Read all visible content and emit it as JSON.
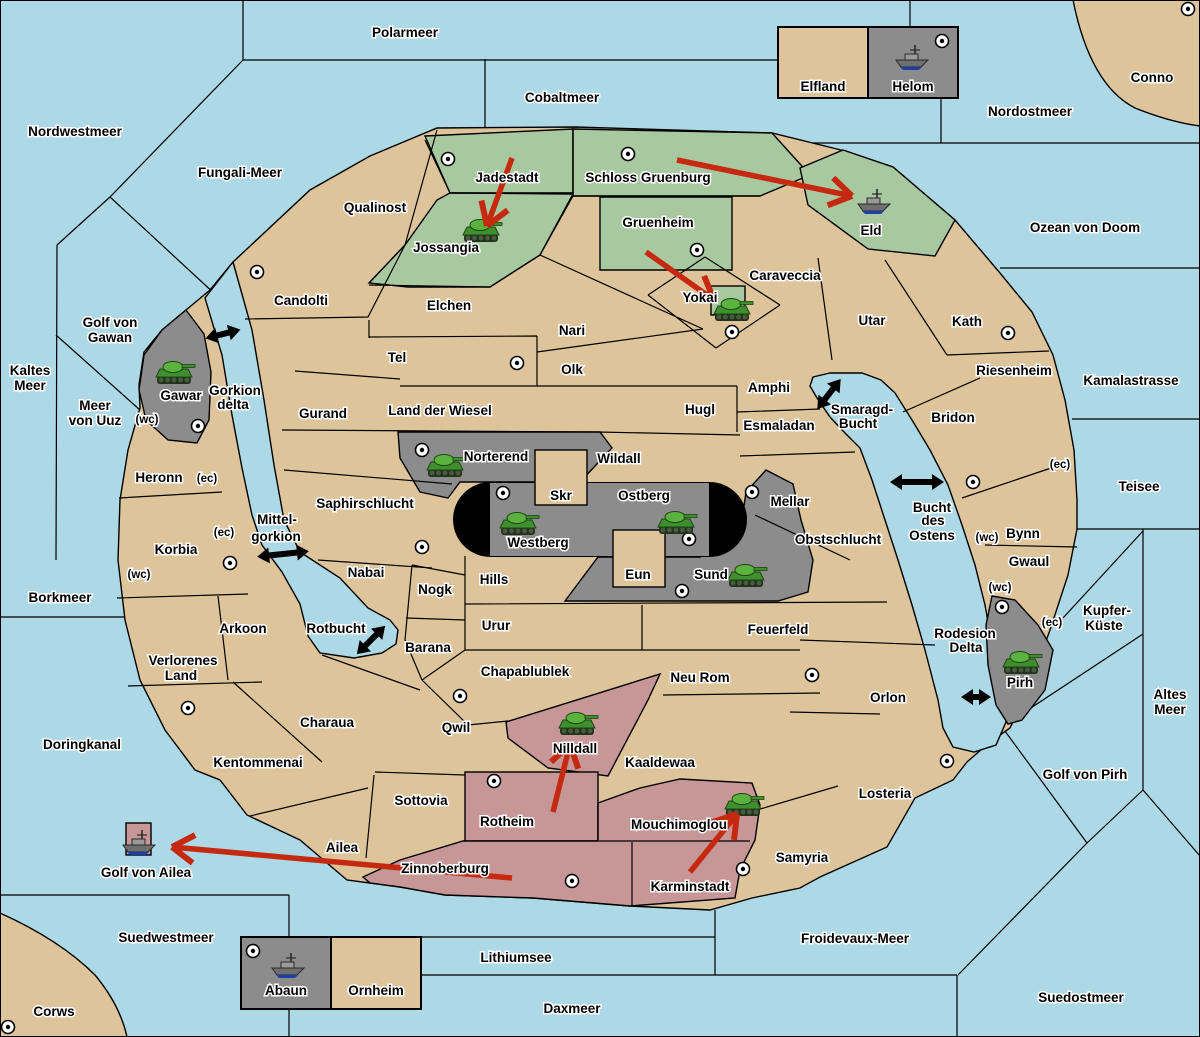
{
  "title": "Strategy map",
  "colors": {
    "sea": "#ADD8E6",
    "land": "#DEC49B",
    "green_power": "#A8C8A0",
    "gray_power": "#8C8C8C",
    "red_power": "#C79696",
    "stadium": "#000000",
    "move_arrow": "#C52A10",
    "strait_arrow": "#000000"
  },
  "map": {
    "sea_labels": [
      {
        "t": "Polarmeer",
        "x": 405,
        "y": 37
      },
      {
        "t": "Nordwestmeer",
        "x": 75,
        "y": 136
      },
      {
        "t": "Fungali-Meer",
        "x": 240,
        "y": 177
      },
      {
        "t": "Cobaltmeer",
        "x": 562,
        "y": 102
      },
      {
        "t": "Nordostmeer",
        "x": 1030,
        "y": 116
      },
      {
        "t": "Ozean von Doom",
        "x": 1085,
        "y": 232
      },
      {
        "t": "Kaltes",
        "x": 30,
        "y": 375
      },
      {
        "t": "Meer",
        "x": 30,
        "y": 390
      },
      {
        "t": "Golf von",
        "x": 110,
        "y": 327
      },
      {
        "t": "Gawan",
        "x": 110,
        "y": 342
      },
      {
        "t": "Meer",
        "x": 95,
        "y": 410
      },
      {
        "t": "von Uuz",
        "x": 95,
        "y": 425
      },
      {
        "t": "Kamalastrasse",
        "x": 1131,
        "y": 385
      },
      {
        "t": "Teisee",
        "x": 1139,
        "y": 491
      },
      {
        "t": "Borkmeer",
        "x": 60,
        "y": 602
      },
      {
        "t": "Kupfer-",
        "x": 1107,
        "y": 615
      },
      {
        "t": "Küste",
        "x": 1104,
        "y": 630
      },
      {
        "t": "Altes",
        "x": 1170,
        "y": 699
      },
      {
        "t": "Meer",
        "x": 1170,
        "y": 714
      },
      {
        "t": "Doringkanal",
        "x": 82,
        "y": 749
      },
      {
        "t": "Golf von Ailea",
        "x": 146,
        "y": 877
      },
      {
        "t": "Suedwestmeer",
        "x": 166,
        "y": 942
      },
      {
        "t": "Corws",
        "x": 54,
        "y": 1016
      },
      {
        "t": "Lithiumsee",
        "x": 516,
        "y": 962
      },
      {
        "t": "Daxmeer",
        "x": 572,
        "y": 1013
      },
      {
        "t": "Froidevaux-Meer",
        "x": 855,
        "y": 943
      },
      {
        "t": "Suedostmeer",
        "x": 1081,
        "y": 1002
      },
      {
        "t": "Golf von Pirh",
        "x": 1085,
        "y": 779
      },
      {
        "t": "Smaragd-",
        "x": 862,
        "y": 414
      },
      {
        "t": "Bucht",
        "x": 858,
        "y": 428
      },
      {
        "t": "Bucht",
        "x": 932,
        "y": 512
      },
      {
        "t": "des",
        "x": 933,
        "y": 525
      },
      {
        "t": "Ostens",
        "x": 932,
        "y": 540
      },
      {
        "t": "Rodesion",
        "x": 965,
        "y": 638
      },
      {
        "t": "Delta",
        "x": 966,
        "y": 652
      },
      {
        "t": "Mittel-",
        "x": 277,
        "y": 524
      },
      {
        "t": "gorkion",
        "x": 276,
        "y": 541
      },
      {
        "t": "Gorkion",
        "x": 235,
        "y": 395
      },
      {
        "t": "delta",
        "x": 233,
        "y": 409
      },
      {
        "t": "Rotbucht",
        "x": 336,
        "y": 633
      },
      {
        "t": "Conno",
        "x": 1152,
        "y": 82
      }
    ],
    "land_labels": [
      {
        "t": "Qualinost",
        "x": 375,
        "y": 212
      },
      {
        "t": "Jadestadt",
        "x": 507,
        "y": 182
      },
      {
        "t": "Schloss Gruenburg",
        "x": 648,
        "y": 182
      },
      {
        "t": "Gruenheim",
        "x": 658,
        "y": 227
      },
      {
        "t": "Jossangia",
        "x": 446,
        "y": 252
      },
      {
        "t": "Eld",
        "x": 871,
        "y": 235
      },
      {
        "t": "Caraveccia",
        "x": 785,
        "y": 280
      },
      {
        "t": "Candolti",
        "x": 301,
        "y": 305
      },
      {
        "t": "Elchen",
        "x": 449,
        "y": 310
      },
      {
        "t": "Nari",
        "x": 572,
        "y": 335
      },
      {
        "t": "Tel",
        "x": 397,
        "y": 362
      },
      {
        "t": "Olk",
        "x": 572,
        "y": 374
      },
      {
        "t": "Yokai",
        "x": 700,
        "y": 302
      },
      {
        "t": "Utar",
        "x": 872,
        "y": 325
      },
      {
        "t": "Kath",
        "x": 967,
        "y": 326
      },
      {
        "t": "Riesenheim",
        "x": 1014,
        "y": 375
      },
      {
        "t": "Gurand",
        "x": 323,
        "y": 418
      },
      {
        "t": "Land der Wiesel",
        "x": 440,
        "y": 415
      },
      {
        "t": "Hugl",
        "x": 700,
        "y": 414
      },
      {
        "t": "Amphi",
        "x": 769,
        "y": 392
      },
      {
        "t": "Esmaladan",
        "x": 779,
        "y": 430
      },
      {
        "t": "Bridon",
        "x": 953,
        "y": 422
      },
      {
        "t": "Gawar",
        "x": 181,
        "y": 400
      },
      {
        "t": "Norterend",
        "x": 496,
        "y": 461
      },
      {
        "t": "Wildall",
        "x": 619,
        "y": 463
      },
      {
        "t": "Skr",
        "x": 561,
        "y": 500
      },
      {
        "t": "Ostberg",
        "x": 644,
        "y": 500
      },
      {
        "t": "Westberg",
        "x": 538,
        "y": 547
      },
      {
        "t": "Mellar",
        "x": 790,
        "y": 506
      },
      {
        "t": "Obstschlucht",
        "x": 838,
        "y": 544
      },
      {
        "t": "Saphirschlucht",
        "x": 365,
        "y": 508
      },
      {
        "t": "Heronn",
        "x": 159,
        "y": 482
      },
      {
        "t": "Korbia",
        "x": 176,
        "y": 554
      },
      {
        "t": "Nabai",
        "x": 366,
        "y": 577
      },
      {
        "t": "Eun",
        "x": 638,
        "y": 579
      },
      {
        "t": "Sund",
        "x": 711,
        "y": 579
      },
      {
        "t": "Hills",
        "x": 494,
        "y": 584
      },
      {
        "t": "Nogk",
        "x": 435,
        "y": 594
      },
      {
        "t": "Bynn",
        "x": 1023,
        "y": 538
      },
      {
        "t": "Gwaul",
        "x": 1029,
        "y": 566
      },
      {
        "t": "Arkoon",
        "x": 243,
        "y": 633
      },
      {
        "t": "Urur",
        "x": 496,
        "y": 630
      },
      {
        "t": "Feuerfeld",
        "x": 778,
        "y": 634
      },
      {
        "t": "Barana",
        "x": 428,
        "y": 652
      },
      {
        "t": "Verlorenes",
        "x": 183,
        "y": 665
      },
      {
        "t": "Land",
        "x": 181,
        "y": 680
      },
      {
        "t": "Chapablublek",
        "x": 525,
        "y": 676
      },
      {
        "t": "Neu Rom",
        "x": 700,
        "y": 682
      },
      {
        "t": "Pirh",
        "x": 1020,
        "y": 687
      },
      {
        "t": "Orlon",
        "x": 888,
        "y": 702
      },
      {
        "t": "Charaua",
        "x": 327,
        "y": 727
      },
      {
        "t": "Qwil",
        "x": 456,
        "y": 732
      },
      {
        "t": "Nilldall",
        "x": 575,
        "y": 753
      },
      {
        "t": "Kaaldewaa",
        "x": 660,
        "y": 767
      },
      {
        "t": "Kentommenai",
        "x": 258,
        "y": 767
      },
      {
        "t": "Sottovia",
        "x": 421,
        "y": 805
      },
      {
        "t": "Rotheim",
        "x": 507,
        "y": 826
      },
      {
        "t": "Mouchimoglou",
        "x": 679,
        "y": 829
      },
      {
        "t": "Losteria",
        "x": 885,
        "y": 798
      },
      {
        "t": "Samyria",
        "x": 802,
        "y": 862
      },
      {
        "t": "Ailea",
        "x": 342,
        "y": 852
      },
      {
        "t": "Zinnoberburg",
        "x": 445,
        "y": 873
      },
      {
        "t": "Karminstadt",
        "x": 690,
        "y": 891
      },
      {
        "t": "Elfland",
        "x": 823,
        "y": 91
      },
      {
        "t": "Helom",
        "x": 913,
        "y": 91
      },
      {
        "t": "Abaun",
        "x": 286,
        "y": 995
      },
      {
        "t": "Ornheim",
        "x": 376,
        "y": 995
      }
    ],
    "coast_markers": [
      {
        "t": "(wc)",
        "x": 147,
        "y": 423
      },
      {
        "t": "(ec)",
        "x": 207,
        "y": 482
      },
      {
        "t": "(ec)",
        "x": 224,
        "y": 536
      },
      {
        "t": "(wc)",
        "x": 139,
        "y": 578
      },
      {
        "t": "(ec)",
        "x": 1060,
        "y": 468
      },
      {
        "t": "(wc)",
        "x": 987,
        "y": 541
      },
      {
        "t": "(wc)",
        "x": 1000,
        "y": 591
      },
      {
        "t": "(ec)",
        "x": 1052,
        "y": 626
      }
    ],
    "supply_centers": [
      [
        448,
        159
      ],
      [
        628,
        154
      ],
      [
        1188,
        9
      ],
      [
        942,
        41
      ],
      [
        257,
        272
      ],
      [
        697,
        250
      ],
      [
        732,
        332
      ],
      [
        517,
        363
      ],
      [
        198,
        426
      ],
      [
        422,
        450
      ],
      [
        503,
        493
      ],
      [
        689,
        539
      ],
      [
        682,
        591
      ],
      [
        752,
        492
      ],
      [
        1008,
        333
      ],
      [
        973,
        482
      ],
      [
        230,
        563
      ],
      [
        422,
        547
      ],
      [
        188,
        708
      ],
      [
        460,
        696
      ],
      [
        812,
        675
      ],
      [
        947,
        761
      ],
      [
        1002,
        607
      ],
      [
        494,
        781
      ],
      [
        572,
        881
      ],
      [
        743,
        869
      ],
      [
        8,
        1027
      ],
      [
        253,
        951
      ]
    ],
    "units": [
      {
        "type": "army",
        "territory": "Jossangia",
        "x": 481,
        "y": 231
      },
      {
        "type": "army",
        "territory": "Gawar",
        "x": 174,
        "y": 373
      },
      {
        "type": "army",
        "territory": "Yokai",
        "x": 732,
        "y": 310
      },
      {
        "type": "army",
        "territory": "Norterend",
        "x": 445,
        "y": 466
      },
      {
        "type": "army",
        "territory": "Westberg",
        "x": 518,
        "y": 524
      },
      {
        "type": "army",
        "territory": "Ostberg",
        "x": 676,
        "y": 523
      },
      {
        "type": "army",
        "territory": "Sund",
        "x": 746,
        "y": 576
      },
      {
        "type": "army",
        "territory": "Pirh",
        "x": 1021,
        "y": 663
      },
      {
        "type": "army",
        "territory": "Nilldall",
        "x": 577,
        "y": 724
      },
      {
        "type": "army",
        "territory": "Mouchimoglou",
        "x": 743,
        "y": 805
      },
      {
        "type": "fleet",
        "territory": "Helom",
        "x": 912,
        "y": 58
      },
      {
        "type": "fleet",
        "territory": "Eld",
        "x": 874,
        "y": 202
      },
      {
        "type": "fleet",
        "territory": "Golf von Ailea",
        "x": 139,
        "y": 843
      },
      {
        "type": "fleet",
        "territory": "Abaun",
        "x": 288,
        "y": 966
      }
    ],
    "moves": [
      {
        "from": [
          512,
          158
        ],
        "to": [
          487,
          226
        ]
      },
      {
        "from": [
          677,
          160
        ],
        "to": [
          852,
          196
        ]
      },
      {
        "from": [
          646,
          252
        ],
        "to": [
          714,
          300
        ]
      },
      {
        "from": [
          553,
          812
        ],
        "to": [
          570,
          744
        ]
      },
      {
        "from": [
          690,
          872
        ],
        "to": [
          737,
          814
        ]
      },
      {
        "from": [
          512,
          878
        ],
        "to": [
          172,
          847
        ]
      }
    ],
    "strait_arrows": [
      {
        "x": 223,
        "y": 334,
        "angle": -14,
        "len": 36
      },
      {
        "x": 283,
        "y": 554,
        "angle": -6,
        "len": 52
      },
      {
        "x": 371,
        "y": 640,
        "angle": -45,
        "len": 40
      },
      {
        "x": 829,
        "y": 394,
        "angle": -52,
        "len": 38
      },
      {
        "x": 917,
        "y": 482,
        "angle": 0,
        "len": 54
      },
      {
        "x": 976,
        "y": 697,
        "angle": 0,
        "len": 30
      }
    ]
  }
}
